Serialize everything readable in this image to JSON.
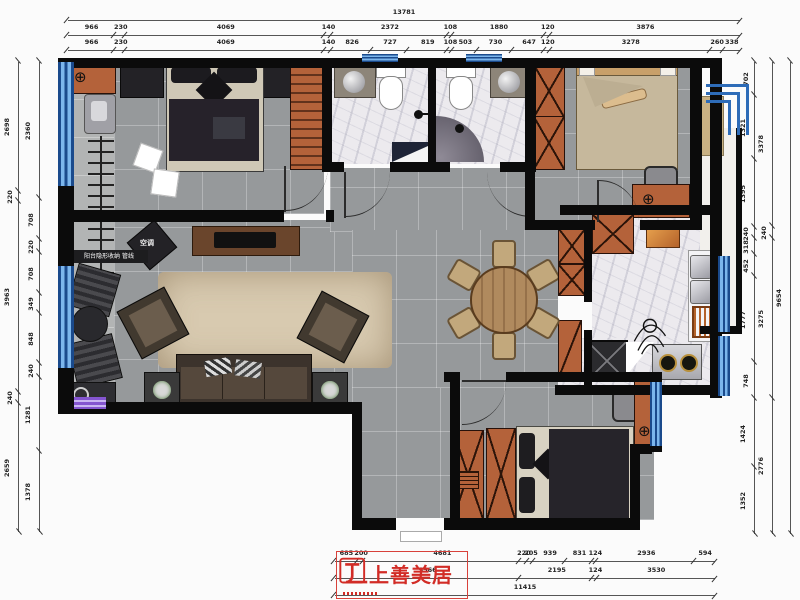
{
  "logo": {
    "brand": "上善美居",
    "accent_color": "#d22c26"
  },
  "labels": {
    "ac_unit": "空调",
    "balcony_note": "阳台隐形收纳 管线"
  },
  "colors": {
    "wall": "#0b0b0b",
    "window_blue": "#7cb6ec",
    "cabinet_orange": "#b4623a",
    "floor_gray": "#96999b",
    "marble": "#eceaee",
    "rug_beige": "#d8cab0",
    "logo_red": "#d22c26"
  },
  "dimensions": {
    "top": {
      "row1": [
        "13781"
      ],
      "row2": [
        "966",
        "230",
        "4069",
        "140",
        "2372",
        "108",
        "1880",
        "120",
        "3876"
      ],
      "row3": [
        "966",
        "230",
        "4069",
        "140",
        "826",
        "727",
        "819",
        "108",
        "503",
        "730",
        "647",
        "120",
        "3278",
        "260",
        "338"
      ]
    },
    "bottom": {
      "row1": [
        "685",
        "200",
        "4681",
        "220",
        "205",
        "939",
        "831",
        "124",
        "2936",
        "594"
      ],
      "row2": [
        "5566",
        "2195",
        "124",
        "3530"
      ],
      "row3": [
        "11415"
      ]
    },
    "left": {
      "outer": [
        "2698",
        "220",
        "3963",
        "240",
        "2659"
      ],
      "inner": [
        "2360",
        "708",
        "220",
        "708",
        "349",
        "848",
        "240",
        "1281",
        "1378"
      ]
    },
    "right": {
      "inner": [
        "702",
        "1321",
        "1395",
        "240",
        "318",
        "452",
        "1777",
        "748",
        "1424",
        "1352"
      ],
      "middle": [
        "3378",
        "240",
        "3275",
        "2776"
      ],
      "outer": [
        "9654"
      ]
    }
  }
}
